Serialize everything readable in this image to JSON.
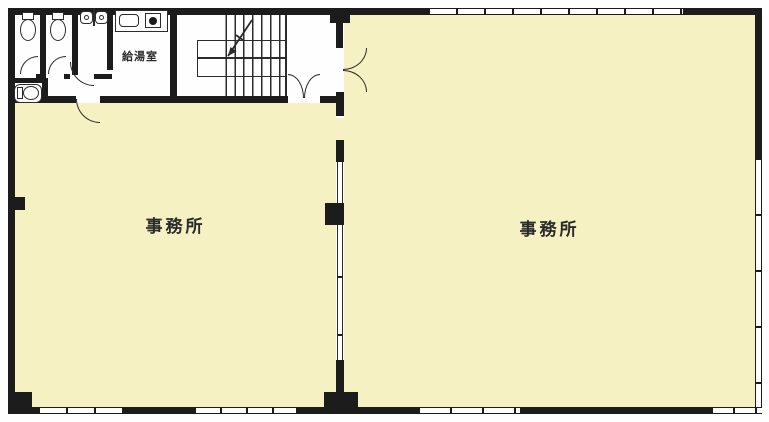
{
  "plan": {
    "name": "office-floor-plan",
    "rooms": {
      "office_left": {
        "label": "事務所"
      },
      "office_right": {
        "label": "事務所"
      },
      "kitchenette": {
        "label": "給湯室"
      }
    },
    "colors": {
      "floor": "#F6F1C3",
      "wall": "#1C1C1C",
      "line": "#2B2B2B",
      "page_bg": "#FEFEFE"
    }
  }
}
